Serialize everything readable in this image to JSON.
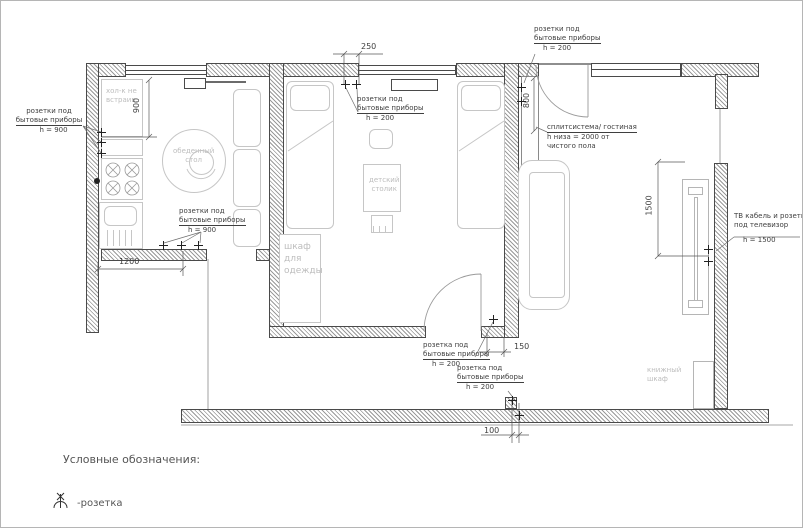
{
  "annotations": {
    "a1": {
      "lines": [
        "розетки под",
        "бытовые приборы",
        "h = 900"
      ]
    },
    "a2": {
      "lines": [
        "розетки под",
        "бытовые приборы",
        "h = 900"
      ]
    },
    "a3": {
      "lines": [
        "розетки под",
        "бытовые приборы",
        "h = 200"
      ]
    },
    "a4": {
      "lines": [
        "розетки под",
        "бытовые приборы",
        "h = 200"
      ]
    },
    "a5": {
      "lines": [
        "сплитсистема/ гостиная",
        "h низа = 2000 от",
        "чистого пола"
      ]
    },
    "a6": {
      "lines": [
        "ТВ кабель и розетка",
        "под телевизор",
        "h = 1500"
      ]
    },
    "a7": {
      "lines": [
        "розетка под",
        "бытовые приборы",
        "h = 200"
      ]
    },
    "a8": {
      "lines": [
        "розетка под",
        "бытовые приборы",
        "h = 200"
      ]
    }
  },
  "dimensions": {
    "d900": "900",
    "d1200": "1200",
    "d250": "250",
    "d800": "800",
    "d1500": "1500",
    "d150": "150",
    "d100": "100"
  },
  "furniture_labels": {
    "fridge": {
      "l1": "хол-к не",
      "l2": "встраив."
    },
    "dining": {
      "l1": "обеденный",
      "l2": "стол"
    },
    "kids_table": {
      "l1": "детский",
      "l2": "столик"
    },
    "wardrobe": {
      "l1": "шкаф",
      "l2": "для",
      "l3": "одежды"
    },
    "bookcase": {
      "l1": "книжный",
      "l2": "шкаф"
    }
  },
  "legend": {
    "title": "Условные обозначения:",
    "socket_label": "-розетка"
  },
  "colors": {
    "wall_line": "#4a4a4a",
    "hatch": "#9a9a9a",
    "furniture": "#c6c6c6",
    "annotation": "#3f3f3f"
  }
}
